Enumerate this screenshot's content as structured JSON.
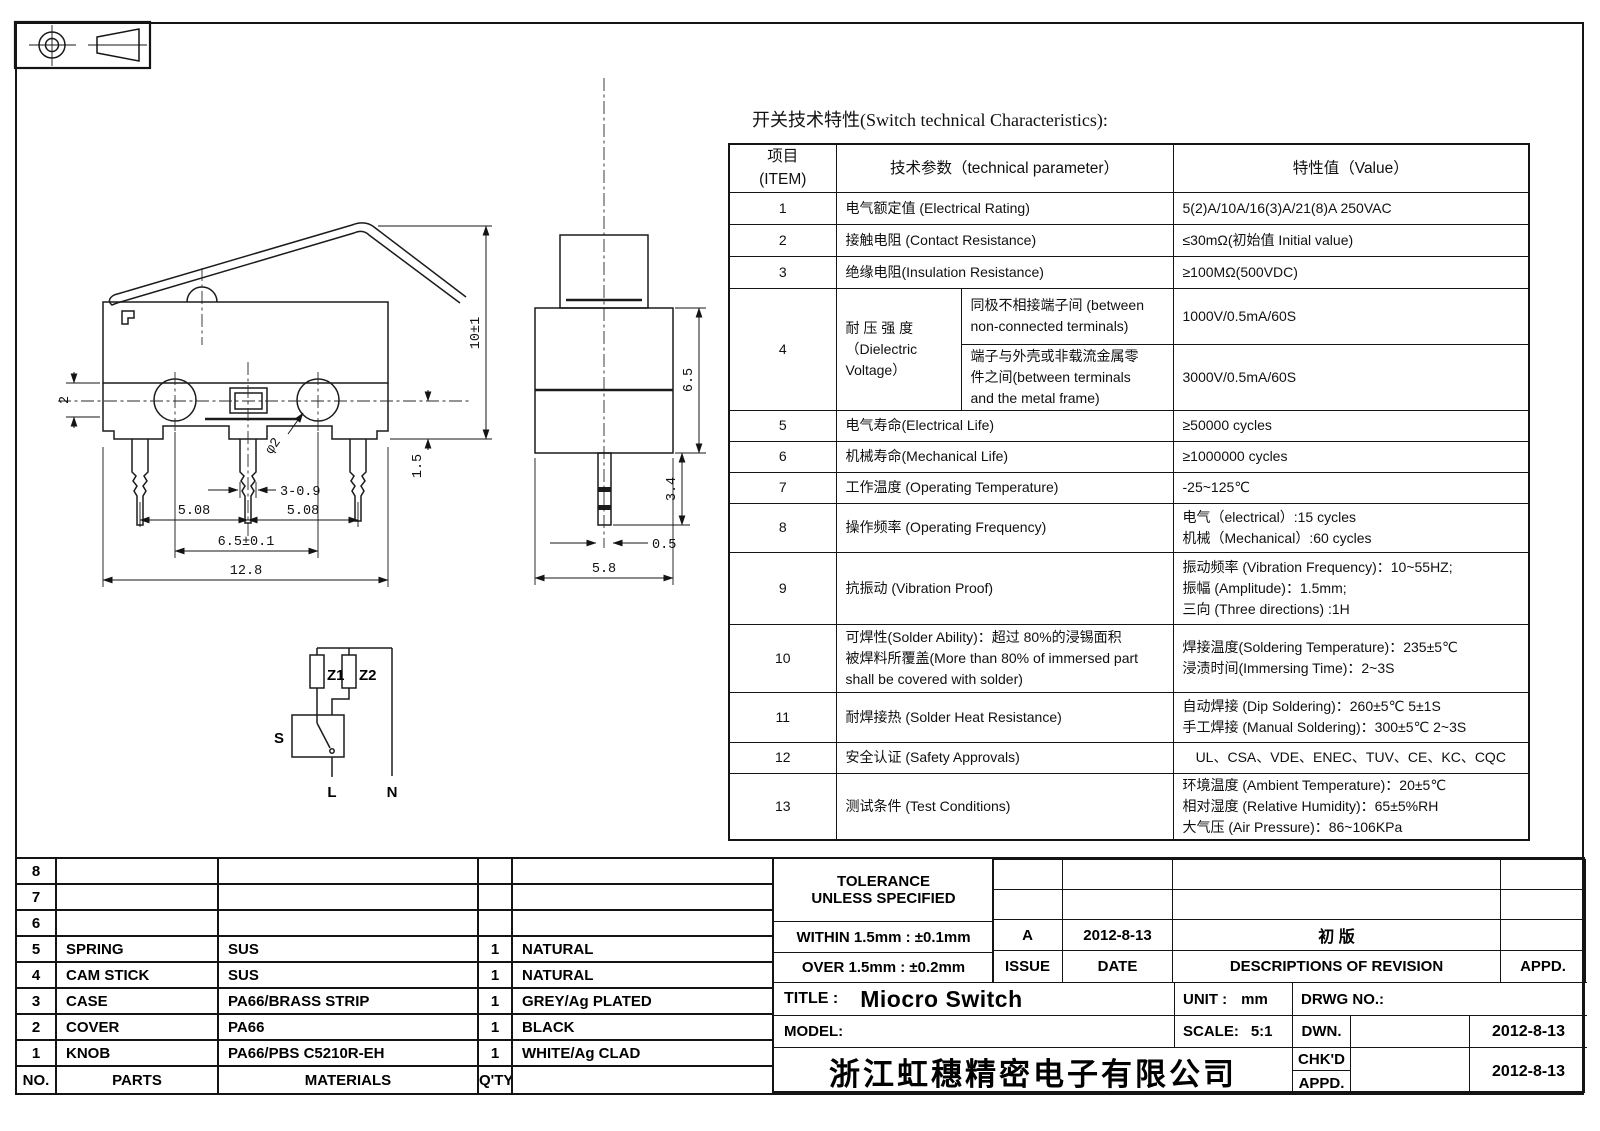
{
  "heading": "开关技术特性(Switch technical Characteristics):",
  "spec_table": {
    "header": {
      "item_l1": "项目",
      "item_l2": "(ITEM)",
      "param": "技术参数（technical parameter）",
      "value": "特性值（Value）"
    },
    "rows": {
      "r1": {
        "no": "1",
        "param": "电气额定值 (Electrical Rating)",
        "value": "5(2)A/10A/16(3)A/21(8)A  250VAC"
      },
      "r2": {
        "no": "2",
        "param": "接触电阻 (Contact  Resistance)",
        "value": "≤30mΩ(初始值 Initial value)"
      },
      "r3": {
        "no": "3",
        "param": "绝缘电阻(Insulation Resistance)",
        "value": "≥100MΩ(500VDC)"
      },
      "r4": {
        "no": "4",
        "param_l1": "耐 压 强 度",
        "param_l2": "（Dielectric",
        "param_l3": "Voltage）",
        "sub1_cond_l1": "同极不相接端子间 (between",
        "sub1_cond_l2": "non-connected terminals)",
        "sub1_value": "1000V/0.5mA/60S",
        "sub2_cond_l1": "端子与外壳或非载流金属零",
        "sub2_cond_l2": "件之间(between terminals",
        "sub2_cond_l3": "and the metal frame)",
        "sub2_value": "3000V/0.5mA/60S"
      },
      "r5": {
        "no": "5",
        "param": "电气寿命(Electrical Life)",
        "value": "≥50000 cycles"
      },
      "r6": {
        "no": "6",
        "param": "机械寿命(Mechanical Life)",
        "value": "≥1000000 cycles"
      },
      "r7": {
        "no": "7",
        "param": "工作温度 (Operating Temperature)",
        "value": "-25~125℃"
      },
      "r8": {
        "no": "8",
        "param": "操作频率 (Operating Frequency)",
        "value_l1": "电气（electrical）:15 cycles",
        "value_l2": "机械（Mechanical）:60 cycles"
      },
      "r9": {
        "no": "9",
        "param": "抗振动 (Vibration Proof)",
        "value_l1": "振动频率 (Vibration Frequency)：10~55HZ;",
        "value_l2": "振幅 (Amplitude)：1.5mm;",
        "value_l3": "三向 (Three directions) :1H"
      },
      "r10": {
        "no": "10",
        "param_l1": "可焊性(Solder Ability)：超过 80%的浸锡面积",
        "param_l2": "被焊料所覆盖(More than 80% of immersed part",
        "param_l3": "shall be covered with solder)",
        "value_l1": "焊接温度(Soldering Temperature)：235±5℃",
        "value_l2": "浸渍时间(Immersing Time)：2~3S"
      },
      "r11": {
        "no": "11",
        "param": "耐焊接热 (Solder Heat Resistance)",
        "value_l1": "自动焊接 (Dip Soldering)：260±5℃ 5±1S",
        "value_l2": "手工焊接 (Manual Soldering)：300±5℃ 2~3S"
      },
      "r12": {
        "no": "12",
        "param": "安全认证 (Safety Approvals)",
        "value": "UL、CSA、VDE、ENEC、TUV、CE、KC、CQC"
      },
      "r13": {
        "no": "13",
        "param": "测试条件 (Test Conditions)",
        "value_l1": "环境温度 (Ambient Temperature)：20±5℃",
        "value_l2": "相对湿度 (Relative Humidity)：65±5%RH",
        "value_l3": "大气压 (Air Pressure)：86~106KPa"
      }
    }
  },
  "dims": {
    "side": {
      "base_height": "2",
      "height_overall": "10±1",
      "pin_offset": "1.5",
      "pin_size": "3-0.9",
      "pitch_left": "5.08",
      "pitch_right": "5.08",
      "hole_pitch": "6.5±0.1",
      "overall_width": "12.8",
      "hole_dia": "φ2"
    },
    "front": {
      "body_height": "6.5",
      "pin_length": "3.4",
      "pin_width": "0.5",
      "body_width": "5.8"
    }
  },
  "circuit": {
    "z1": "Z1",
    "z2": "Z2",
    "s": "S",
    "l": "L",
    "n": "N"
  },
  "parts_table": {
    "rows": {
      "r8": {
        "no": "8",
        "part": "",
        "material": "",
        "qty": "",
        "color": ""
      },
      "r7": {
        "no": "7",
        "part": "",
        "material": "",
        "qty": "",
        "color": ""
      },
      "r6": {
        "no": "6",
        "part": "",
        "material": "",
        "qty": "",
        "color": ""
      },
      "r5": {
        "no": "5",
        "part": "SPRING",
        "material": "SUS",
        "qty": "1",
        "color": "NATURAL"
      },
      "r4": {
        "no": "4",
        "part": "CAM STICK",
        "material": "SUS",
        "qty": "1",
        "color": "NATURAL"
      },
      "r3": {
        "no": "3",
        "part": "CASE",
        "material": "PA66/BRASS STRIP",
        "qty": "1",
        "color": "GREY/Ag PLATED"
      },
      "r2": {
        "no": "2",
        "part": "COVER",
        "material": "PA66",
        "qty": "1",
        "color": "BLACK"
      },
      "r1": {
        "no": "1",
        "part": "KNOB",
        "material": "PA66/PBS C5210R-EH",
        "qty": "1",
        "color": "WHITE/Ag CLAD"
      },
      "hdr": {
        "no": "NO.",
        "part": "PARTS",
        "material": "MATERIALS",
        "qty": "Q'TY",
        "color": ""
      }
    }
  },
  "tolerance": {
    "line1": "TOLERANCE",
    "line2": "UNLESS  SPECIFIED",
    "within": "WITHIN 1.5mm : ±0.1mm",
    "over": "OVER 1.5mm : ±0.2mm"
  },
  "revision": {
    "issue_value": "A",
    "date_value": "2012-8-13",
    "desc_value": "初  版",
    "appd_value": "",
    "issue_label": "ISSUE",
    "date_label": "DATE",
    "desc_label": "DESCRIPTIONS OF REVISION",
    "appd_label": "APPD."
  },
  "title_block": {
    "title_label": "TITLE :",
    "title": "Miocro Switch",
    "unit_label": "UNIT :",
    "unit": "mm",
    "drwg_label": "DRWG NO.:",
    "model_label": "MODEL:",
    "scale_label": "SCALE:",
    "scale": "5:1",
    "dwn_label": "DWN.",
    "dwn_date": "2012-8-13",
    "chkd_label": "CHK'D",
    "appd_label": "APPD.",
    "chkd_date": "2012-8-13",
    "company": "浙江虹穗精密电子有限公司"
  },
  "colors": {
    "ink": "#141414",
    "paper": "#ffffff"
  }
}
